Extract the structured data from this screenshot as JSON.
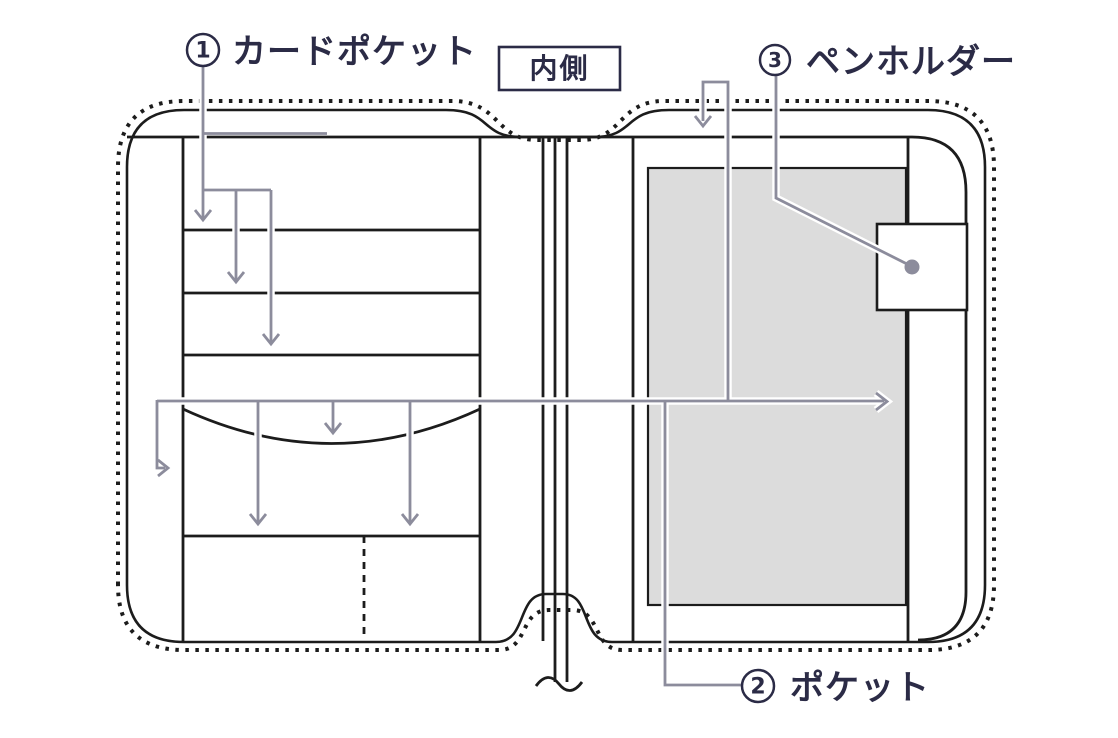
{
  "badge": {
    "label": "内側"
  },
  "callouts": {
    "card_pocket": {
      "number": "1",
      "label": "カードポケット"
    },
    "pocket": {
      "number": "2",
      "label": "ポケット"
    },
    "pen_holder": {
      "number": "3",
      "label": "ペンホルダー"
    }
  },
  "colors": {
    "ink": "#2b2b46",
    "line": "#1c1c1c",
    "leader": "#8c8c9c",
    "panel_fill": "#dcdcdc",
    "background": "#ffffff"
  }
}
